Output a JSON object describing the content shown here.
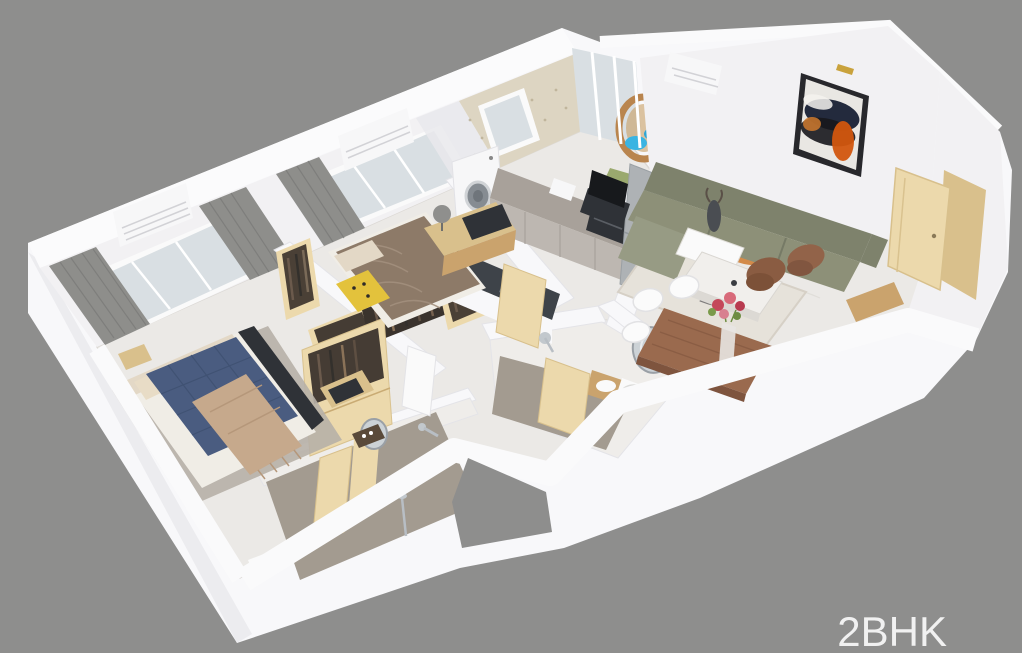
{
  "label": {
    "text": "2BHK"
  },
  "scene": {
    "kind": "3d-isometric-cutaway-floor-plan-render",
    "unit_type": "2BHK apartment",
    "rooms": [
      "master-bedroom",
      "master-bathroom",
      "wardrobe-corridor",
      "second-bedroom",
      "kitchen",
      "utility-balcony",
      "living-room",
      "dining-area",
      "common-bathroom",
      "entry-foyer",
      "window-balcony"
    ],
    "furniture": {
      "master_bedroom": [
        "navy-quilted-bed",
        "tan-fringed-throw",
        "beige-pillows",
        "area-rug",
        "foot-bench",
        "open-wardrobe",
        "bedside-table",
        "floor-tray"
      ],
      "second_bedroom": [
        "brown-duvet-bed",
        "yellow-patterned-throw",
        "tv-dresser",
        "television",
        "sphere-lamp",
        "open-closets-with-clothes"
      ],
      "kitchen": [
        "washing-machine",
        "gray-countertop",
        "toaster",
        "microwave",
        "refrigerator",
        "sink-peninsula",
        "speckled-wallpaper",
        "window"
      ],
      "utility_balcony": [
        "rattan-hanging-egg-chair",
        "blue-cushions",
        "grass-mat"
      ],
      "living_room": [
        "olive-l-shaped-sectional-sofa",
        "abstract-wall-painting",
        "picture-light",
        "marble-coffee-table",
        "decor-figurine",
        "patterned-rug",
        "leather-accent-chairs",
        "tv-cabinet"
      ],
      "dining_area": [
        "wooden-dining-table",
        "white-shell-chairs",
        "flower-vase"
      ],
      "bathrooms": [
        "round-mirrors",
        "wall-faucets",
        "toilets",
        "wood-vanity",
        "shower-set",
        "wood-doors"
      ],
      "shell": [
        "split-ac-units",
        "sliding-windows",
        "gray-curtains",
        "entry-wood-door",
        "white-cutaway-walls",
        "marble-floor"
      ]
    }
  },
  "palette": {
    "bg": "#8e8e8d",
    "label": "#f1f1f1",
    "wall": "#f8f8fa",
    "wall_face": "#f2f1f3",
    "wall_shade": "#ececef",
    "band": "#fbfbfc",
    "floor": "#ebe9e6",
    "tile": "#a39b90",
    "glass": "#d9dfe3",
    "curtain": "#8e8e8b",
    "sheer": "#e9e9ec",
    "wallpaper": "#ddd5c2",
    "wood": "#ecd9ac",
    "wood_mid": "#d9c08c",
    "wood_deep": "#caa36d",
    "navy": "#4a5c80",
    "tan": "#c6a98c",
    "linen": "#e3d8c6",
    "duvet_brown": "#8d7a68",
    "dark": "#2f3237",
    "olive": "#8d9078",
    "olive_dark": "#7e826c",
    "olive_light": "#979b84",
    "leather": "#8a5c42",
    "counter": "#a8a19a",
    "cabinet": "#bdb7b1",
    "appliance": "#f7f7f8",
    "steel": "#aeb2b5",
    "chrome": "#c2c8cd",
    "table_wood": "#9a6a4e",
    "rug": "#b7b0a7",
    "rug_living": "#e6e2da",
    "orange": "#cf7a2e",
    "painting_orange": "#d2560e",
    "painting_dark": "#1d2230",
    "grass": "#9aa96e",
    "cushion_blue": "#3ab4e2",
    "flower": "#c4485a",
    "flower_light": "#d86a7a",
    "leaf": "#7a9a4a",
    "yellow": "#e3c23c"
  }
}
